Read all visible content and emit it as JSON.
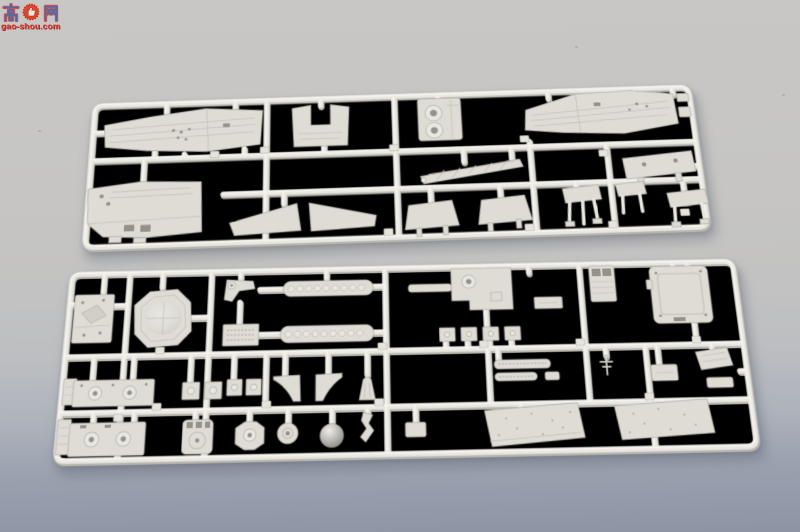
{
  "watermark": {
    "char_left": "高",
    "char_right": "网",
    "site": "gao-shou.com",
    "colors": {
      "wm-char": "#4d61a3",
      "wm-outline": "#cf3a30",
      "wm-emblem": "#e23a2c",
      "wm-site": "#e0362b"
    }
  },
  "scene": {
    "description": "Product photograph of two light-gray injection-molded styrene sprues (runner frames) holding ship model kit parts, laid on a gray studio background that darkens to blue-gray at the bottom",
    "colors": {
      "bg-top": "#c8c7c5",
      "bg-mid": "#c2c2c2",
      "bg-bottom": "#8d94a4",
      "plastic": "#e9e7e1",
      "plastic-under": "#b7b5ae",
      "plastic-hi": "#f6f5f1",
      "part": "#dedcd5",
      "part-line": "#b2b0a9",
      "part-dark": "#93918a",
      "tag": "#e6e4de"
    }
  },
  "sprues": {
    "top": {
      "label": "upper sprue",
      "parts": [
        "planked forward deck",
        "U-shaped bulkhead",
        "twin barbette block",
        "planked aft deck",
        "clip fittings",
        "superstructure deckhouse",
        "wing platform pair",
        "trapezoid platform",
        "trapezoid platform",
        "lattice crane boom",
        "gun mount platform",
        "tripod platform",
        "tripod platform",
        "table platform",
        "part number tags"
      ]
    },
    "bottom": {
      "label": "lower sprue",
      "parts": [
        "pyramid-roof box",
        "octagonal pad",
        "davit with pulley",
        "chain strip",
        "number placard",
        "chain strip",
        "deck platform with hatch",
        "ladder column",
        "angle fitting",
        "hatch lid panel",
        "small equipment box",
        "hull strip with portholes",
        "porthole plates",
        "porthole plates",
        "gusset bracket",
        "gusset bracket",
        "fan vent",
        "fitting tabs",
        "textured strips",
        "antenna mast",
        "equipment box",
        "angled panel",
        "tall equipment box",
        "hull strip with portholes",
        "slotted turret",
        "octagonal cylinder",
        "round fitting",
        "radar dome",
        "hook bracket",
        "small box",
        "speckled deck panel",
        "speckled deck panel",
        "small plate",
        "part number tags"
      ]
    }
  }
}
